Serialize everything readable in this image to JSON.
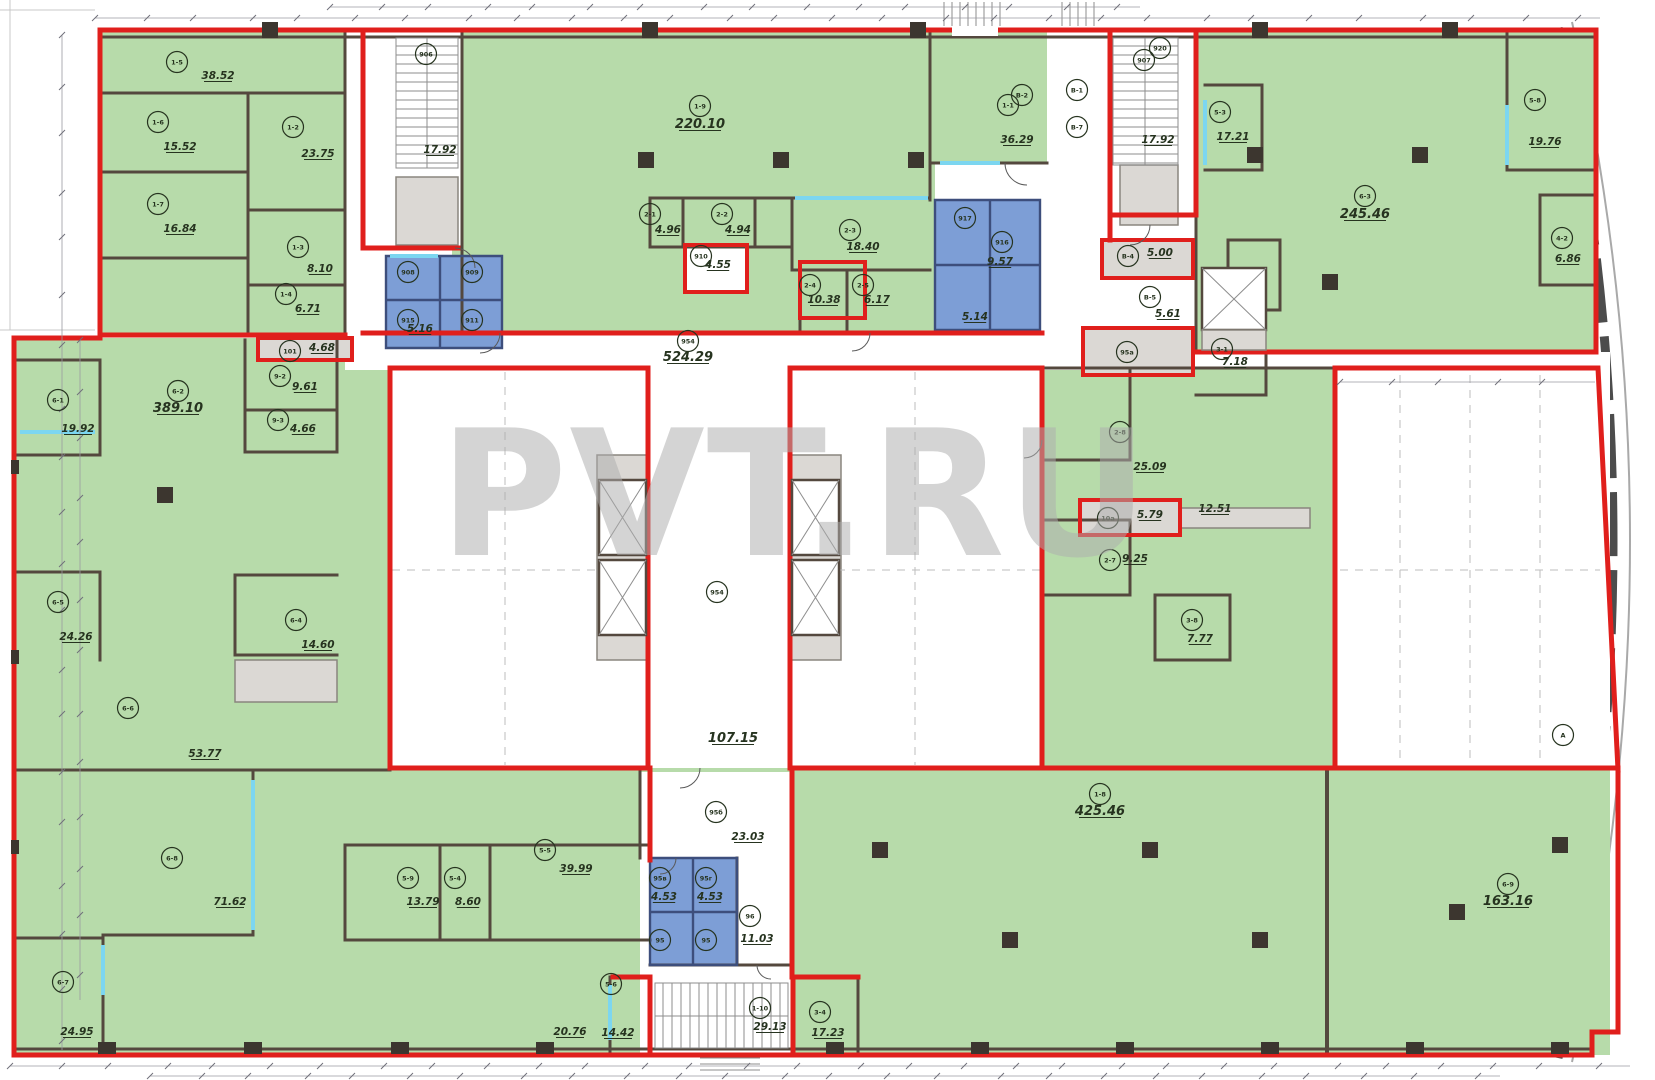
{
  "drawing": {
    "watermark": "PVT.RU",
    "type": "architectural-floor-plan"
  },
  "colors": {
    "room_green": "#b7dbaa",
    "sanitary_blue": "#7d9ed6",
    "outline_red": "#e01f1c",
    "wall_dark": "#54483e",
    "technical_gray": "#dbd8d4",
    "partition_cyan": "#7cd6f0",
    "watermark_gray": "#aeaeae",
    "label_green": "#26331f"
  },
  "rooms": {
    "tl1": {
      "tag": "1-5",
      "area": "38.52"
    },
    "tl2": {
      "tag": "1-6",
      "area": "15.52"
    },
    "tl3": {
      "tag": "1-7",
      "area": "16.84"
    },
    "tl4": {
      "tag": "1-2",
      "area": "23.75"
    },
    "tl5": {
      "tag": "1-3",
      "area": "8.10"
    },
    "tl6": {
      "tag": "1-4",
      "area": "6.71"
    },
    "big1": {
      "tag": "1-9",
      "area": "220.10"
    },
    "m1": {
      "tag": "2-1",
      "area": "4.96"
    },
    "m2": {
      "tag": "2-2",
      "area": "4.94"
    },
    "m3": {
      "tag": "2-3",
      "area": "18.40"
    },
    "m4": {
      "tag": "2-4",
      "area": "10.38"
    },
    "m5": {
      "tag": "2-5",
      "area": "6.17"
    },
    "m6": {
      "tag": "910",
      "area": "4.55"
    },
    "wc1": {
      "tag": "908",
      "area": "5.16"
    },
    "wc2": {
      "tag": "917",
      "area": "9.57"
    },
    "wc3": {
      "tag": "916",
      "area": "5.14"
    },
    "v1": {
      "tag": "1-1",
      "area": "36.29"
    },
    "st1": {
      "tag": "906",
      "area": "17.92"
    },
    "st2": {
      "tag": "907",
      "area": "17.92"
    },
    "s53": {
      "tag": "5-3",
      "area": "17.21"
    },
    "b5": {
      "tag": "В-4",
      "area": "5.00"
    },
    "b6": {
      "tag": "В-5",
      "area": "5.61"
    },
    "e1": {
      "tag": "3-1",
      "area": "7.18"
    },
    "big2": {
      "tag": "6-3",
      "area": "245.46"
    },
    "tr1": {
      "tag": "5-8",
      "area": "19.76"
    },
    "tr2": {
      "tag": "4-2",
      "area": "6.86"
    },
    "cor1": {
      "tag": "954",
      "area": "524.29"
    },
    "cor2": {
      "tag": "95д",
      "area": "107.15"
    },
    "bigL": {
      "tag": "6-2",
      "area": "389.10"
    },
    "l1": {
      "tag": "6-1",
      "area": "19.92"
    },
    "l2": {
      "tag": "9-2",
      "area": "9.61"
    },
    "l3": {
      "tag": "9-3",
      "area": "4.66"
    },
    "l4": {
      "tag": "101",
      "area": "4.68"
    },
    "l5": {
      "tag": "6-5",
      "area": "24.26"
    },
    "l6": {
      "tag": "6-4",
      "area": "14.60"
    },
    "l7": {
      "tag": "6-6",
      "area": "53.77"
    },
    "l8": {
      "tag": "6-8",
      "area": "71.62"
    },
    "l9": {
      "tag": "6-7",
      "area": "24.95"
    },
    "g1": {
      "tag": "5-9",
      "area": "13.79"
    },
    "g2": {
      "tag": "5-4",
      "area": "8.60"
    },
    "g3": {
      "tag": "5-5",
      "area": "39.99"
    },
    "g4": {
      "tag": "95б",
      "area": "23.03"
    },
    "g5": {
      "tag": "95в",
      "area": "4.53"
    },
    "g6": {
      "tag": "95г",
      "area": "4.53"
    },
    "g7": {
      "tag": "96",
      "area": "11.03"
    },
    "g8": {
      "tag": "1-10",
      "area": "29.13"
    },
    "g9": {
      "tag": "5-6",
      "area": "14.42"
    },
    "g10": {
      "tag": "5-7",
      "area": "20.76"
    },
    "g11": {
      "tag": "3-4",
      "area": "17.23"
    },
    "big3": {
      "tag": "1-8",
      "area": "425.46"
    },
    "big4": {
      "tag": "6-9",
      "area": "163.16"
    },
    "e2": {
      "tag": "2-8",
      "area": "25.09"
    },
    "e3": {
      "tag": "2-9",
      "area": "12.51"
    },
    "e4": {
      "tag": "10а",
      "area": "5.79"
    },
    "e5": {
      "tag": "2-7",
      "area": "9.25"
    },
    "e6": {
      "tag": "3-8",
      "area": "7.77"
    }
  },
  "markers": {
    "mk1": {
      "tag": "909"
    },
    "mk2": {
      "tag": "915"
    },
    "mk3": {
      "tag": "911"
    },
    "mk4": {
      "tag": "95"
    },
    "mk5": {
      "tag": "95"
    },
    "mk6": {
      "tag": "954"
    },
    "mk7": {
      "tag": "В-2"
    },
    "mk8": {
      "tag": "В-1"
    },
    "mk9": {
      "tag": "В-7"
    },
    "mk10": {
      "tag": "920"
    },
    "mk11": {
      "tag": "95а"
    },
    "mk12": {
      "tag": "А"
    }
  }
}
